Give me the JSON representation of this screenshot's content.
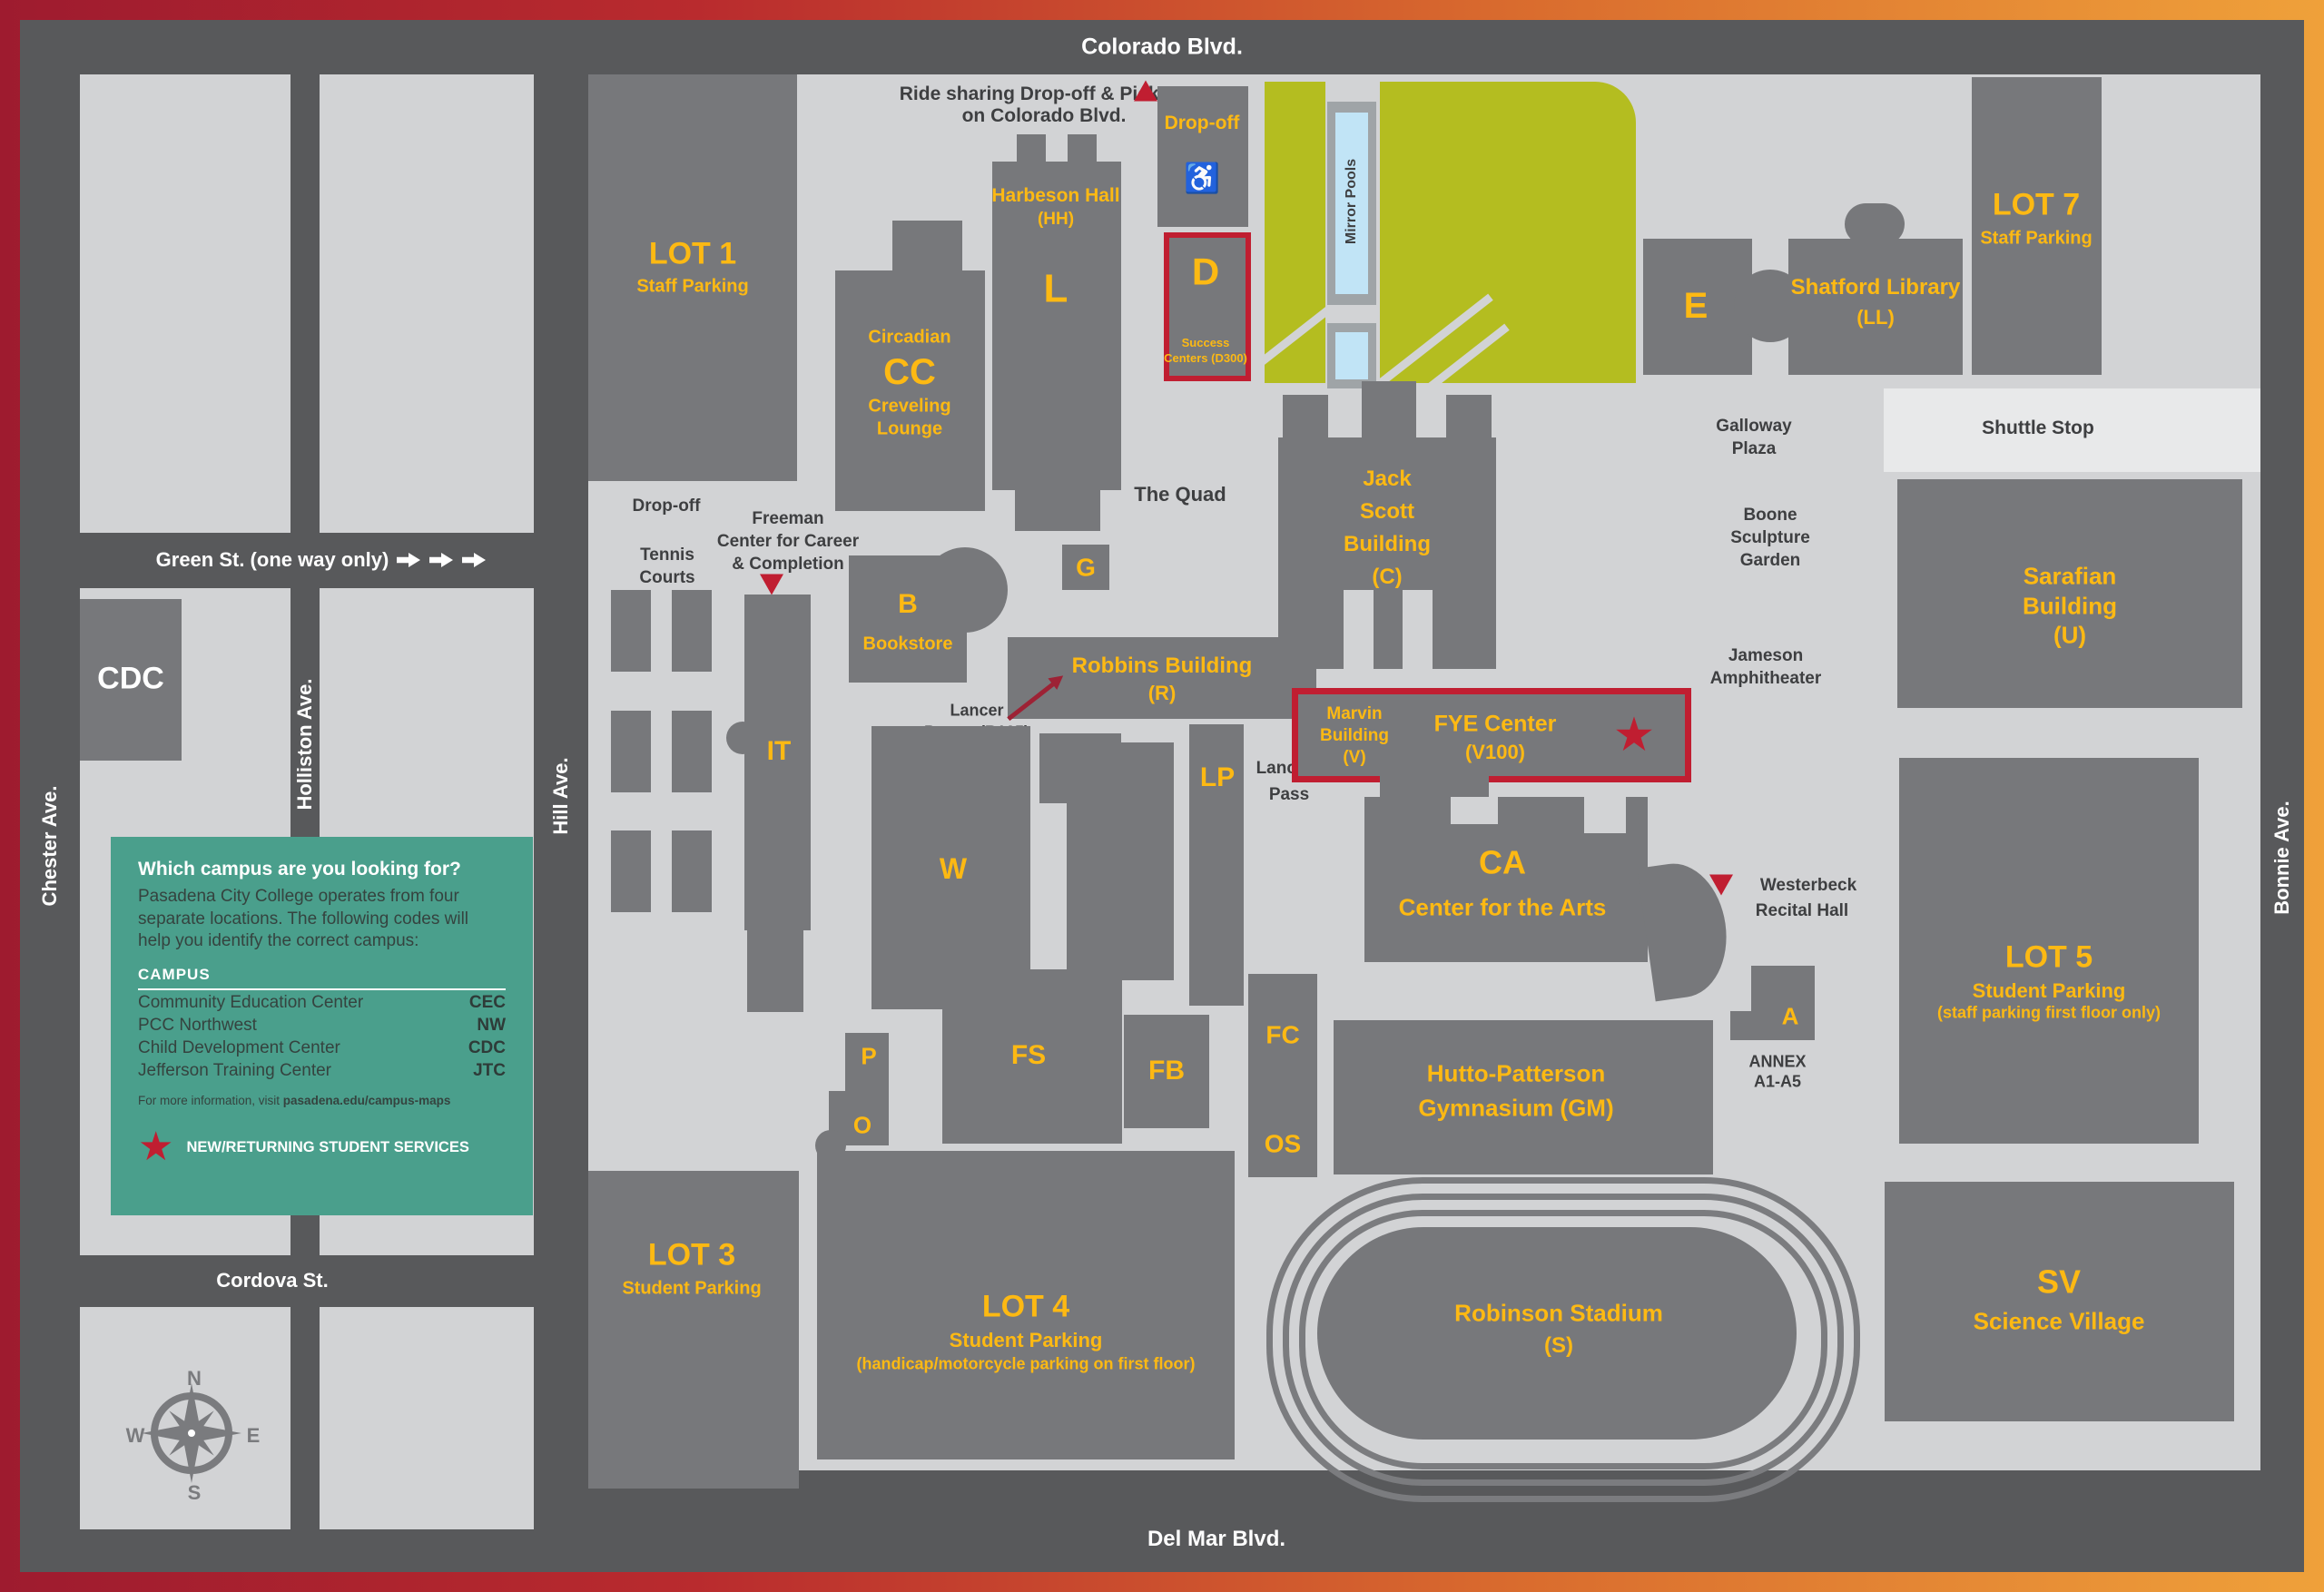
{
  "colors": {
    "gold": "#fdb913",
    "red": "#c01e31",
    "maroon": "#9d2235",
    "teal": "#4a9f8c",
    "lawn": "#b4bd20",
    "pool": "#c1e4f6",
    "building": "#77787b",
    "block": "#d2d3d5",
    "road": "#58595b"
  },
  "streets": {
    "colorado": "Colorado Blvd.",
    "green": "Green St. (one way only)",
    "cordova": "Cordova St.",
    "delmar": "Del Mar Blvd.",
    "chester": "Chester Ave.",
    "holliston": "Holliston Ave.",
    "hill": "Hill Ave.",
    "bonnie": "Bonnie Ave."
  },
  "legend": {
    "heading": "Which campus are you looking for?",
    "body": "Pasadena City College operates from four separate locations. The following codes will help you identify the correct campus:",
    "table_header": "CAMPUS",
    "rows": [
      {
        "name": "Community Education Center",
        "code": "CEC"
      },
      {
        "name": "PCC Northwest",
        "code": "NW"
      },
      {
        "name": "Child Development Center",
        "code": "CDC"
      },
      {
        "name": "Jefferson Training Center",
        "code": "JTC"
      }
    ],
    "footer_text": "For more information, visit ",
    "footer_link": "pasadena.edu/campus-maps",
    "star_icon": "★",
    "star_note": "NEW/RETURNING STUDENT SERVICES"
  },
  "compass": {
    "n": "N",
    "e": "E",
    "s": "S",
    "w": "W"
  },
  "map": {
    "lot1": {
      "title": "LOT 1",
      "subtitle": "Staff Parking"
    },
    "cdc": {
      "label": "CDC"
    },
    "cc": {
      "line1": "Circadian",
      "letter": "CC",
      "line2": "Creveling",
      "line3": "Lounge"
    },
    "harbeson": {
      "name": "Harbeson Hall",
      "code": "(HH)",
      "letter": "L"
    },
    "rideshare": {
      "line1": "Ride sharing Drop-off & Pick-up",
      "line2": "on Colorado Blvd."
    },
    "dropoff_colorado": {
      "label": "Drop-off",
      "icon": "♿"
    },
    "d": {
      "letter": "D",
      "line1": "Success",
      "line2": "Centers (D300)"
    },
    "mirror_pools": {
      "label": "Mirror Pools"
    },
    "e": {
      "letter": "E"
    },
    "shatford": {
      "name": "Shatford Library",
      "code": "(LL)"
    },
    "lot7": {
      "title": "LOT 7",
      "subtitle": "Staff Parking"
    },
    "shuttle": {
      "label": "Shuttle Stop"
    },
    "galloway": {
      "line1": "Galloway",
      "line2": "Plaza"
    },
    "quad": {
      "label": "The Quad"
    },
    "jack_scott": {
      "line1": "Jack",
      "line2": "Scott",
      "line3": "Building",
      "line4": "(C)"
    },
    "boone": {
      "line1": "Boone",
      "line2": "Sculpture",
      "line3": "Garden"
    },
    "jameson": {
      "line1": "Jameson",
      "line2": "Amphitheater"
    },
    "sarafian": {
      "line1": "Sarafian",
      "line2": "Building",
      "line3": "(U)"
    },
    "g": {
      "letter": "G"
    },
    "robbins": {
      "name": "Robbins Building",
      "code": "(R)"
    },
    "z": {
      "letter": "Z"
    },
    "lancer_pantry": {
      "line1": "Lancer",
      "line2": "Pantry (R125)"
    },
    "bookstore": {
      "letter": "B",
      "name": "Bookstore"
    },
    "tennis": {
      "line1": "Tennis",
      "line2": "Courts"
    },
    "dropoff_hill": {
      "label": "Drop-off"
    },
    "freeman": {
      "line1": "Freeman",
      "line2": "Center for Career",
      "line3": "& Completion"
    },
    "it": {
      "letter": "IT"
    },
    "w": {
      "letter": "W"
    },
    "lp": {
      "letter": "LP"
    },
    "lancers_pass": {
      "line1": "Lancers",
      "line2": "Pass"
    },
    "marvin": {
      "line1": "Marvin",
      "line2": "Building",
      "line3": "(V)"
    },
    "fye": {
      "name": "FYE Center",
      "code": "(V100)",
      "star": "★"
    },
    "ca": {
      "letter": "CA",
      "name": "Center for the Arts"
    },
    "westerbeck": {
      "line1": "Westerbeck",
      "line2": "Recital Hall"
    },
    "hutto": {
      "line1": "Hutto-Patterson",
      "line2": "Gymnasium (GM)"
    },
    "annex": {
      "letter": "A",
      "line1": "ANNEX",
      "line2": "A1-A5"
    },
    "lot5": {
      "title": "LOT 5",
      "subtitle": "Student Parking",
      "note": "(staff parking first floor only)"
    },
    "lot3": {
      "title": "LOT 3",
      "subtitle": "Student Parking"
    },
    "lot4": {
      "title": "LOT 4",
      "subtitle": "Student Parking",
      "note": "(handicap/motorcycle parking on first floor)"
    },
    "stadium": {
      "name": "Robinson Stadium",
      "code": "(S)"
    },
    "sv": {
      "letter": "SV",
      "name": "Science Village"
    }
  }
}
